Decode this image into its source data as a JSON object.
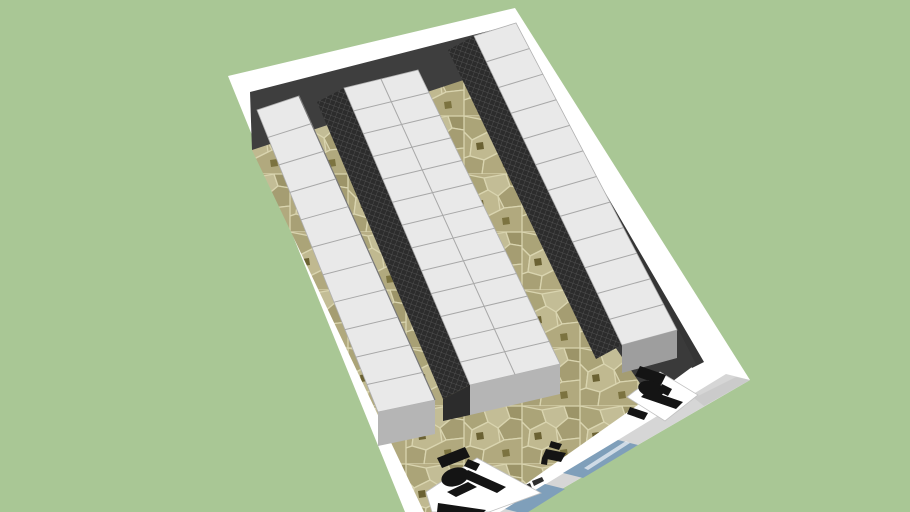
{
  "colors": {
    "background": "#a9c795",
    "wall_top": "#ffffff",
    "wall_exterior": "#d6d6d6",
    "wall_exterior_dark": "#c3c3c3",
    "wall_interior": "#3e3e3e",
    "wall_interior_side": "#353535",
    "entry_floor": "#3a3a3a",
    "stone_base": "#b7ae85",
    "stone_grout": "#d9d4af",
    "stone_a": "#aba478",
    "stone_b": "#c3bd96",
    "stone_c": "#9c9468",
    "stone_d": "#b1a97e",
    "stone_e": "#a59d72",
    "stone_f": "#c0b990",
    "stone_g": "#a8a075",
    "stone_accent_a": "#6b6233",
    "stone_accent_b": "#7c7340",
    "rack_top": "#e9e9e9",
    "rack_divider": "#a8a8a8",
    "rack_end": "#b5b5b5",
    "rack_end_dark": "#9e9e9e",
    "mesh_base": "#2c2c2c",
    "mesh_grid": "#5a5a5a",
    "glass": "#7f9fba",
    "glass_streak": "#e9eff4",
    "desk": "#ffffff",
    "furniture": "#141414",
    "signage": "#2e2e2e"
  },
  "scene": {
    "rack_rows": [
      {
        "id": "left",
        "rack_units": 11,
        "banks": 1
      },
      {
        "id": "middle",
        "rack_units": 13,
        "banks": 2
      },
      {
        "id": "right",
        "rack_units": 12,
        "banks": 1
      }
    ],
    "desks": 2,
    "chairs": 3,
    "glass_panels": 2
  }
}
